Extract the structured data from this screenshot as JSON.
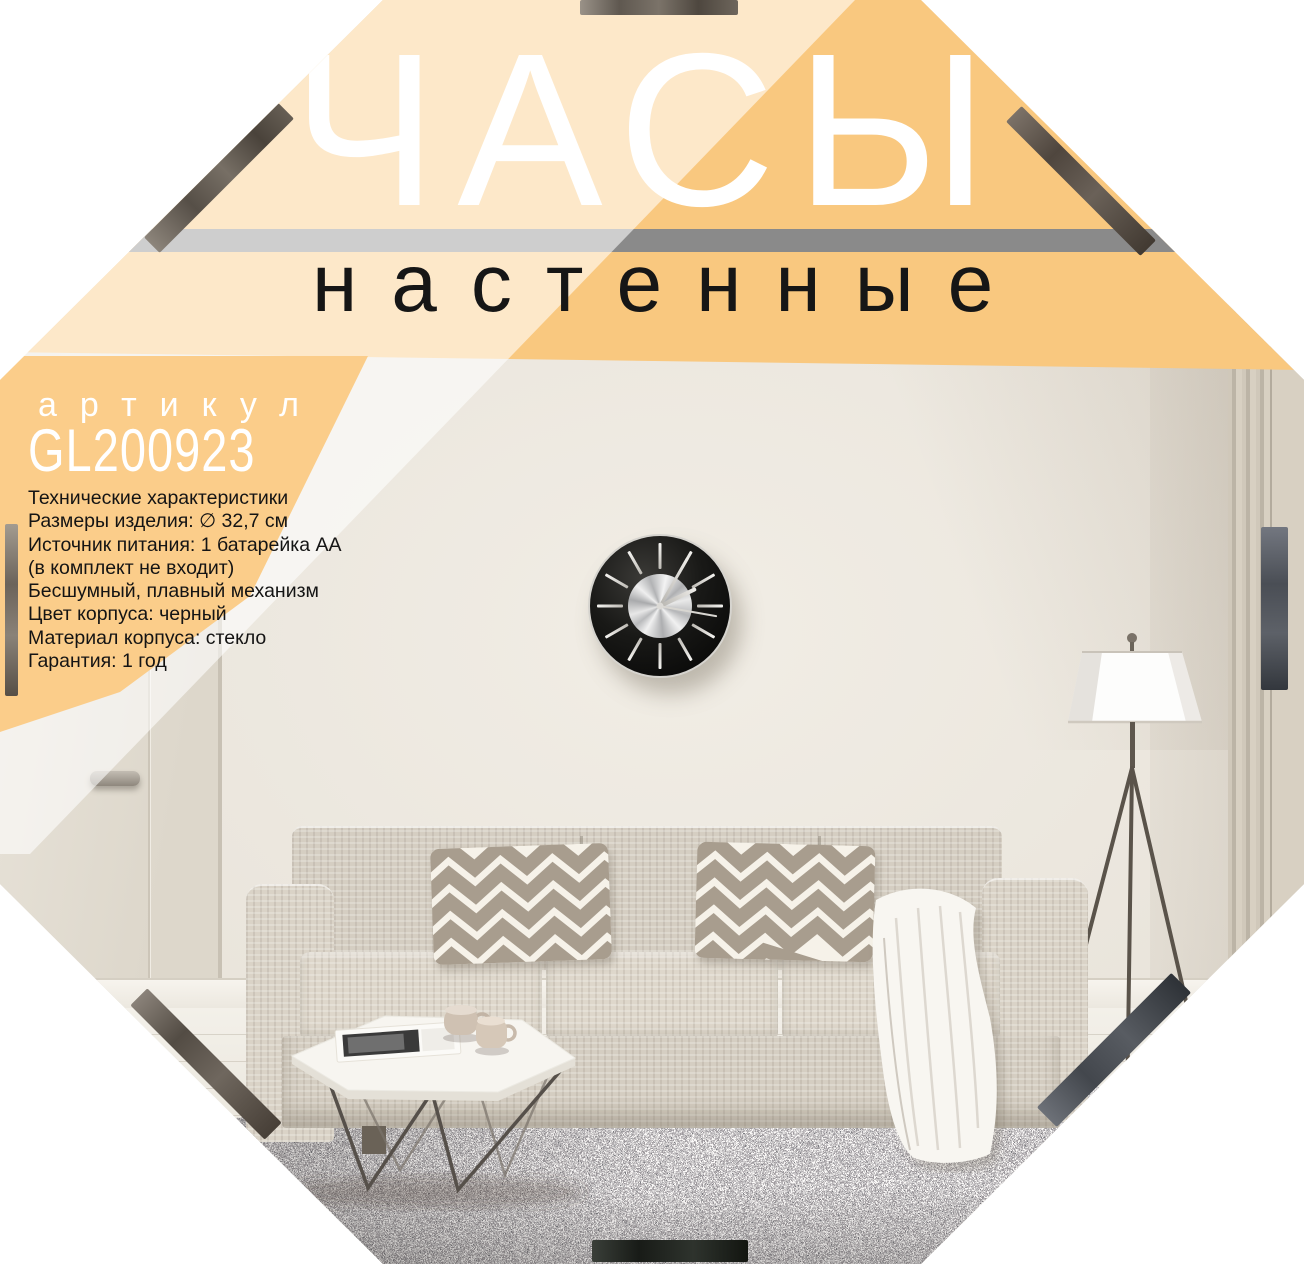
{
  "title": {
    "main": "ЧАСЫ",
    "sub": "настенные"
  },
  "article": {
    "label": "артикул",
    "code": "GL200923"
  },
  "specs": {
    "lines": [
      "Технические характеристики",
      "Размеры изделия: ∅ 32,7 см",
      "Источник питания: 1 батарейка АА",
      "(в комплект не входит)",
      "Бесшумный, плавный механизм",
      "Цвет корпуса: черный",
      "Материал корпуса: стекло",
      "Гарантия: 1 год"
    ]
  },
  "colors": {
    "band_peach": "#f9c87f",
    "band_peach_light": "#fce7cd",
    "artikul_bg": "#fbcd8a",
    "stripe_gray": "#8a8a8a",
    "stripe_gray_light": "#d6d6d6",
    "clock_face": "#121210",
    "clock_center_silver": "#c9cacc"
  },
  "clock": {
    "time_shown": "2:06"
  }
}
